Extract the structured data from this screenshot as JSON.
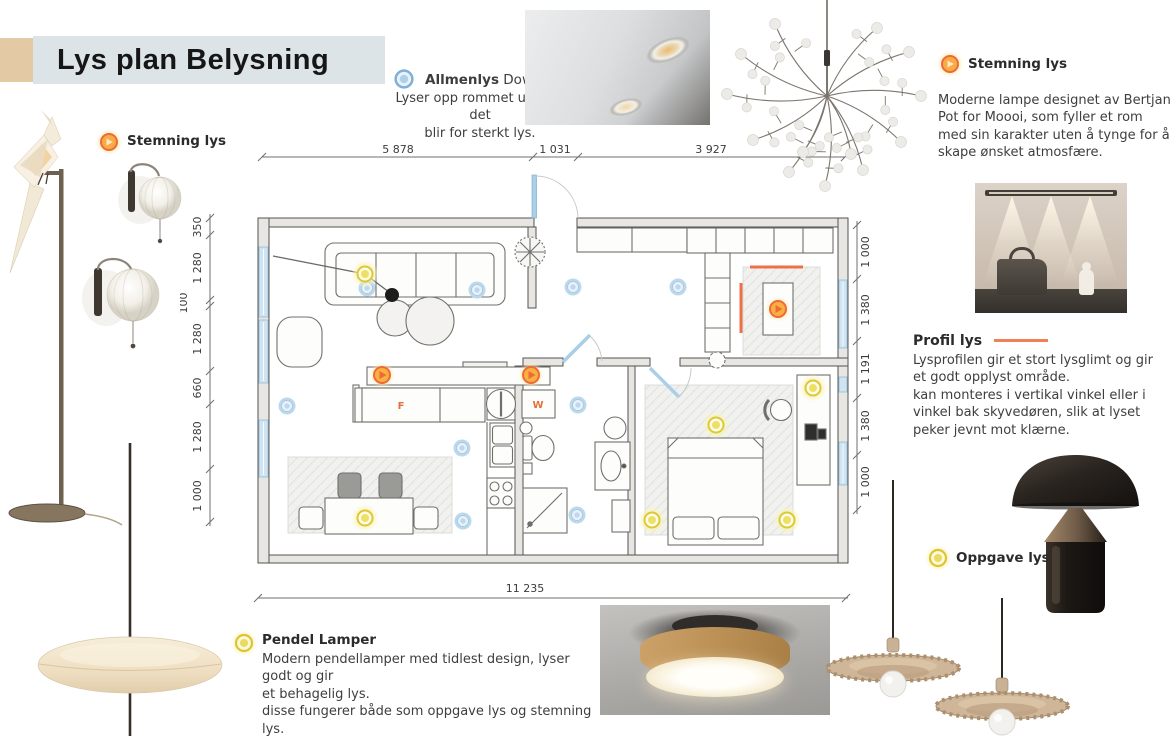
{
  "title": "Lys plan Belysning",
  "sections": {
    "stemning_left": {
      "label": "Stemning lys"
    },
    "allmenlys": {
      "title_bold": "Allmenlys",
      "title_rest": " Downlight",
      "line1": "Lyser opp rommet uten at det",
      "line2": "blir for sterkt lys."
    },
    "stemning_right": {
      "label": "Stemning lys",
      "desc": "Moderne lampe designet av Bertjan Pot for Moooi, som fyller et rom med sin karakter uten å tynge for å skape ønsket atmosfære."
    },
    "profil": {
      "title": "Profil lys",
      "desc1": "Lysprofilen gir et stort lysglimt og gir et godt opplyst område.",
      "desc2": "kan monteres i vertikal vinkel eller i vinkel bak skyvedøren, slik at lyset peker jevnt mot klærne."
    },
    "oppgave": {
      "label": "Oppgave lys"
    },
    "pendel": {
      "title": "Pendel Lamper",
      "desc1": "Modern pendellamper med tidlest design, lyser godt og gir",
      "desc2": "et behagelig lys.",
      "desc3": "disse fungerer både som oppgave lys og stemning lys."
    }
  },
  "floorplan": {
    "dims_top": [
      "5 878",
      "1 031",
      "3 927"
    ],
    "dim_bottom": "11 235",
    "dims_left": [
      "350",
      "1 280",
      "100",
      "1 280",
      "660",
      "1 280",
      "1 000"
    ],
    "dims_right": [
      "1 000",
      "1 380",
      "1 191",
      "1 380",
      "1 000"
    ],
    "labels": {
      "fridge": "F",
      "washer": "W"
    },
    "lights": {
      "downlights": [
        [
          187,
          148
        ],
        [
          297,
          150
        ],
        [
          107,
          266
        ],
        [
          282,
          308
        ],
        [
          283,
          381
        ],
        [
          393,
          147
        ],
        [
          498,
          147
        ],
        [
          398,
          265
        ],
        [
          397,
          375
        ]
      ],
      "pendants": [
        [
          185,
          134
        ],
        [
          185,
          378
        ],
        [
          536,
          285
        ],
        [
          472,
          380
        ],
        [
          607,
          380
        ],
        [
          633,
          248
        ]
      ],
      "accent_spots": [
        [
          202,
          235
        ],
        [
          351,
          235
        ],
        [
          598,
          169
        ]
      ]
    }
  },
  "colors": {
    "accent_orange": "#ee6a3c",
    "glow_yellow": "#f2e14b",
    "downlight_blue": "#9cc4e0",
    "banner": "#dce4e7",
    "beige": "#e4caa4"
  }
}
